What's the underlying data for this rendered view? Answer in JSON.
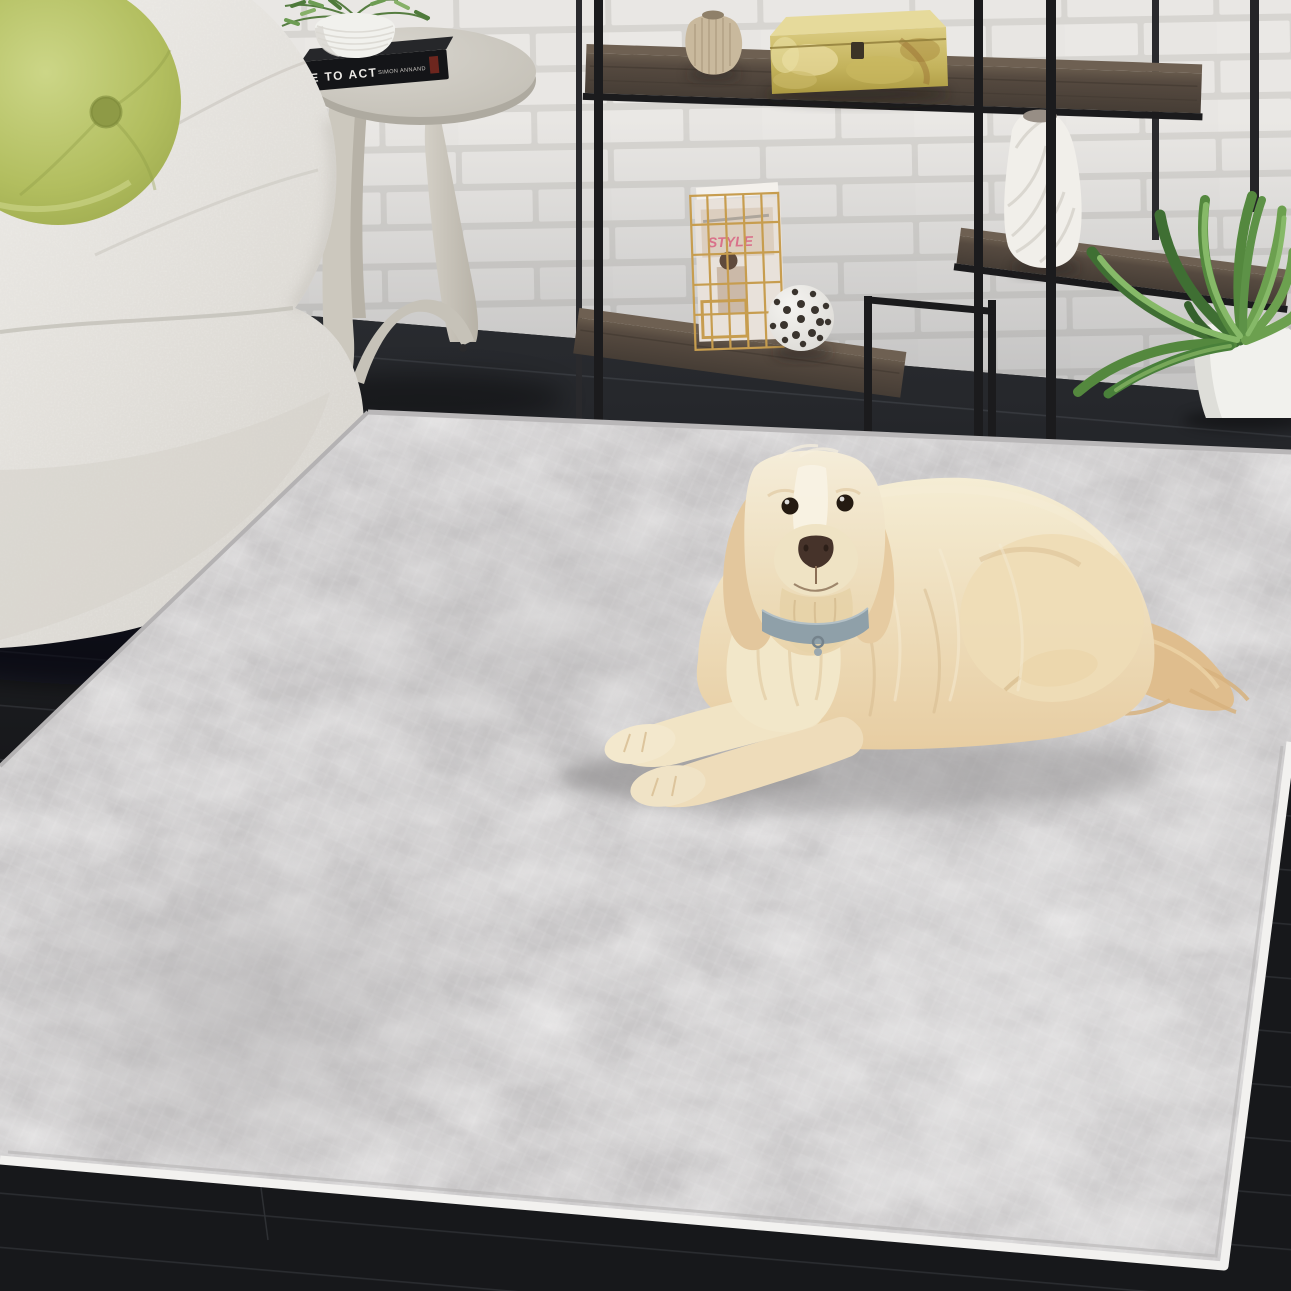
{
  "meta": {
    "type": "lifestyle-photograph",
    "description": "Cream goldendoodle dog lying on a distressed light-gray area rug in a modern living room with a white painted brick wall, white boucle sofa with green round pillow, gray round side table with books and a plant, black metal etagere shelf with decor objects, and a potted plant on dark wood flooring."
  },
  "palette": {
    "wall_brick": "#e9e7e4",
    "wall_mortar": "#d7d5d1",
    "floor": "#17181a",
    "rug_base": "#c8c6c7",
    "rug_blotch": "#eeedec",
    "rug_binding": "#f2f1ef",
    "sofa": "#e9e7e2",
    "pillow_green": "#b4c067",
    "pillow_button": "#8e9a46",
    "dog_cream": "#eedfbe",
    "dog_gold": "#e2c89c",
    "collar_gray": "#8fa0a9",
    "shelf_metal": "#1b1b1d",
    "shelf_wood": "#55493f",
    "onyx_box": "#c9ba68",
    "vase_beige": "#c9b99d",
    "vase_white": "#f1efea",
    "plant_green": "#54883e",
    "table_gray": "#ccc9c1",
    "pot_white": "#f1f1ed",
    "book_black": "#141518"
  },
  "objects": {
    "book": {
      "spine_title": "E TO ACT",
      "spine_author": "SIMON ANNAND"
    },
    "magazine": {
      "cover_text": "STYLE"
    }
  }
}
